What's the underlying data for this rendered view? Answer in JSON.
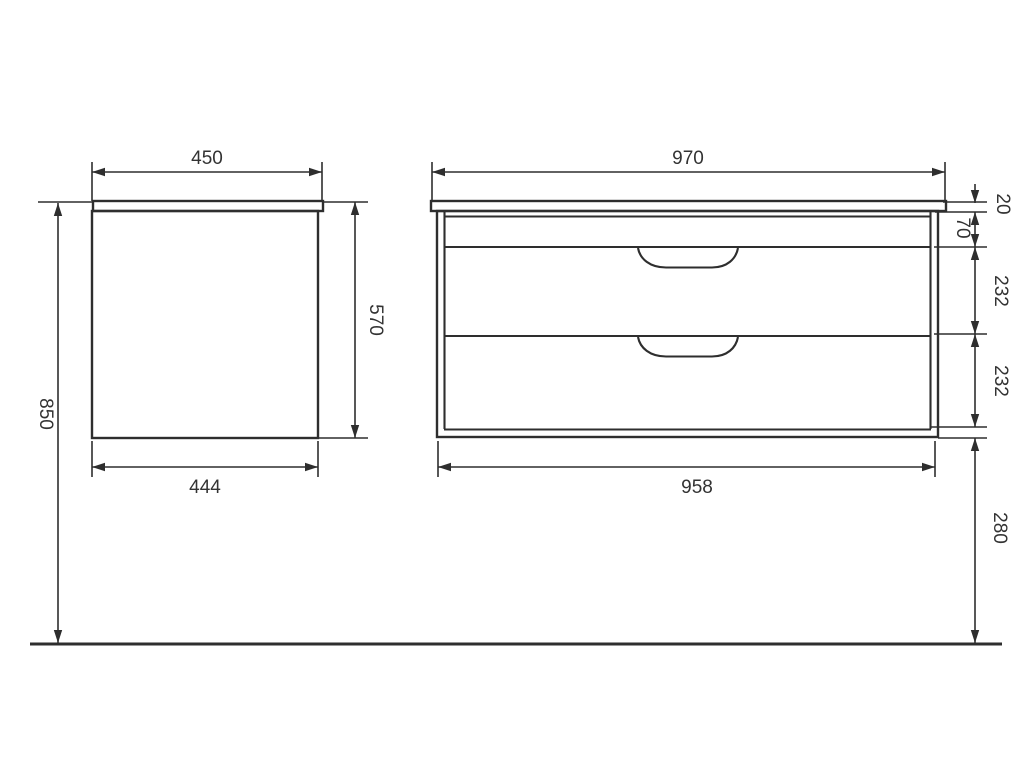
{
  "drawing": {
    "side_view": {
      "width_top": "450",
      "height_body": "570",
      "width_bottom": "444",
      "height_overall": "850"
    },
    "front_view": {
      "width_top": "970",
      "countertop_thickness": "20",
      "top_section_height": "70",
      "drawer_1_height": "232",
      "drawer_2_height": "232",
      "width_bottom": "958",
      "floor_clearance": "280"
    },
    "colors": {
      "background": "#ffffff",
      "lines": "#2e2e2e",
      "text": "#333333"
    }
  }
}
